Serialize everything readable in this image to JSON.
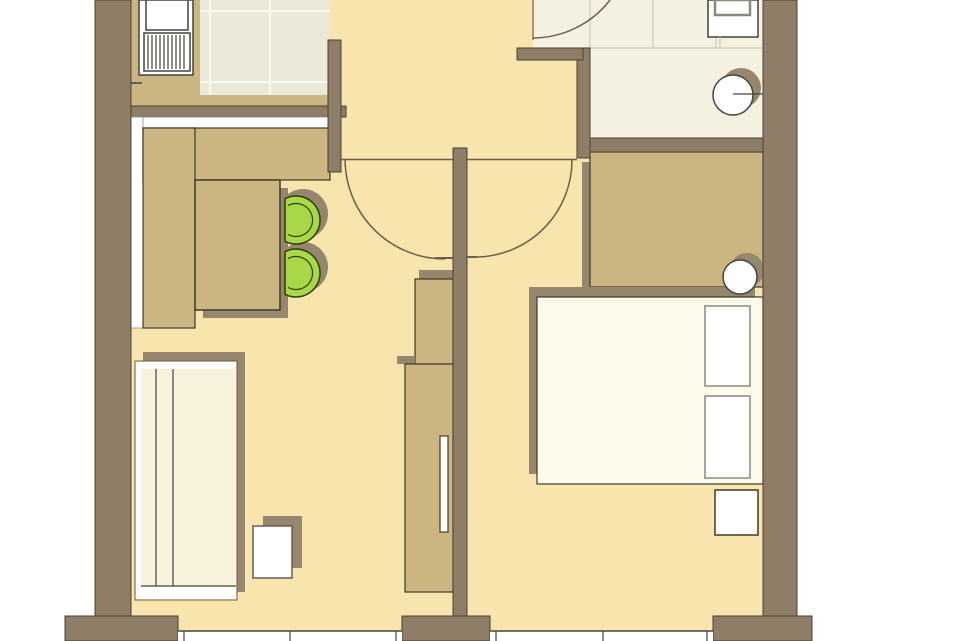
{
  "title": "apartment-floor-plan",
  "canvas": {
    "width": 960,
    "height": 641,
    "background": "#ffffff"
  },
  "palette": {
    "wall": "#8e7d67",
    "wallStroke": "#4c4134",
    "floor": "#f8e4ad",
    "bathFloor": "#f5f1e1",
    "tile": "#e9e8d9",
    "grout": "#fafaf0",
    "tan": "#cbb581",
    "furnStroke": "#3f3b2b",
    "cream": "#f8f2dc",
    "bedCream": "#fdfaeb",
    "white": "#ffffff",
    "shadow": "#95866d",
    "thinLine": "#6a5f4d",
    "dark": "#45433b",
    "grayBorder": "#8a887c",
    "tileLine": "#c6c2b0",
    "green": "#a8d847",
    "greenStroke": "#2e3c04"
  },
  "rooms": [
    "kitchen",
    "living-room",
    "hallway",
    "bathroom",
    "bedroom"
  ],
  "shapes": [
    {
      "name": "floor-hallway",
      "type": "rect",
      "rect": [
        330,
        0,
        247,
        160
      ],
      "fill": "floor",
      "interactable": false
    },
    {
      "name": "floor-living-room",
      "type": "rect",
      "rect": [
        131,
        106,
        322,
        525
      ],
      "fill": "floor",
      "interactable": false
    },
    {
      "name": "floor-bedroom",
      "type": "rect",
      "rect": [
        467,
        138,
        296,
        493
      ],
      "fill": "floor",
      "interactable": false
    },
    {
      "name": "floor-bathroom",
      "type": "rect",
      "rect": [
        590,
        0,
        173,
        140
      ],
      "fill": "bathFloor",
      "interactable": false
    },
    {
      "name": "floor-bathroom-entry",
      "type": "rect",
      "rect": [
        533,
        0,
        57,
        48
      ],
      "fill": "bathFloor",
      "interactable": false
    },
    {
      "name": "floor-kitchen-tiles",
      "type": "rect",
      "rect": [
        200,
        0,
        130,
        95
      ],
      "fill": "tile",
      "interactable": false
    },
    {
      "name": "kitchen-tile-grout-vertical",
      "type": "vlines",
      "xs": [
        210,
        270
      ],
      "y1": 0,
      "y2": 95,
      "stroke": "grout",
      "sw": 2,
      "interactable": false
    },
    {
      "name": "kitchen-tile-grout-horizontal",
      "type": "hlines",
      "ys": [
        11,
        82
      ],
      "x1": 200,
      "x2": 330,
      "stroke": "grout",
      "sw": 2,
      "interactable": false
    },
    {
      "name": "bathroom-tile-lines-vertical",
      "type": "vlines",
      "xs": [
        590,
        653,
        716
      ],
      "y1": 0,
      "y2": 48,
      "stroke": "tileLine",
      "sw": 1,
      "interactable": false
    },
    {
      "name": "bathroom-tile-line-horizontal",
      "type": "hlines",
      "ys": [
        48
      ],
      "x1": 590,
      "x2": 763,
      "stroke": "tileLine",
      "sw": 1,
      "interactable": false
    },
    {
      "name": "kitchen-counter-left",
      "type": "rect",
      "rect": [
        131,
        0,
        69,
        106
      ],
      "fill": "tan",
      "interactable": false
    },
    {
      "name": "kitchen-counter-bottom",
      "type": "rect",
      "rect": [
        200,
        95,
        130,
        11
      ],
      "fill": "tan",
      "interactable": false
    },
    {
      "name": "kitchen-sink-unit",
      "type": "rect",
      "rect": [
        139,
        0,
        54,
        75
      ],
      "fill": "white",
      "stroke": "dark",
      "sw": 1.5,
      "interactable": false
    },
    {
      "name": "kitchen-sink-bowl",
      "type": "rect",
      "rect": [
        146,
        0,
        42,
        30
      ],
      "fill": "white",
      "stroke": "dark",
      "sw": 1.5,
      "interactable": false
    },
    {
      "name": "kitchen-sink-drainer",
      "type": "rect",
      "rect": [
        144,
        33,
        46,
        38
      ],
      "fill": "white",
      "stroke": "dark",
      "sw": 1.5,
      "interactable": false
    },
    {
      "name": "kitchen-drainer-ribs",
      "type": "vlines",
      "xs": [
        148,
        152,
        156,
        160,
        164,
        168,
        172,
        176,
        180,
        184
      ],
      "y1": 35,
      "y2": 69,
      "stroke": "dark",
      "sw": 1.2,
      "interactable": false
    },
    {
      "name": "kitchen-counter-joint-mark",
      "type": "line",
      "p": [
        131,
        83,
        142,
        83
      ],
      "stroke": "dark",
      "sw": 1.5,
      "interactable": false
    },
    {
      "name": "wall-north-kitchen",
      "type": "rect",
      "rect": [
        131,
        106,
        215,
        11
      ],
      "fill": "wall",
      "stroke": "wallStroke",
      "sw": 1,
      "interactable": false
    },
    {
      "name": "sideboard-worktop-top",
      "type": "rect",
      "rect": [
        131,
        117,
        199,
        11
      ],
      "fill": "white",
      "stroke": "grayBorder",
      "sw": 0.75,
      "interactable": false
    },
    {
      "name": "sideboard-worktop-left",
      "type": "rect",
      "rect": [
        131,
        117,
        12,
        211
      ],
      "fill": "white",
      "stroke": "grayBorder",
      "sw": 0.75,
      "interactable": false
    },
    {
      "name": "sideboard-cabinet-top",
      "type": "rect",
      "rect": [
        143,
        128,
        187,
        52
      ],
      "fill": "tan",
      "stroke": "furnStroke",
      "sw": 1.2,
      "interactable": false
    },
    {
      "name": "sideboard-cabinet-left",
      "type": "rect",
      "rect": [
        143,
        128,
        52,
        200
      ],
      "fill": "tan",
      "stroke": "furnStroke",
      "sw": 1.2,
      "interactable": false
    },
    {
      "name": "dining-table-shadow",
      "type": "rect",
      "rect": [
        203,
        188,
        85,
        130
      ],
      "fill": "shadow",
      "interactable": false
    },
    {
      "name": "dining-table",
      "type": "rect",
      "rect": [
        195,
        180,
        85,
        130
      ],
      "fill": "tan",
      "stroke": "furnStroke",
      "sw": 1.5,
      "interactable": false
    },
    {
      "name": "chair-1-shadow",
      "type": "path",
      "d": "M 287 194.8 A 25 25 0 1 1 287 233.2 Z",
      "fill": "shadow",
      "interactable": false
    },
    {
      "name": "chair-2-shadow",
      "type": "path",
      "d": "M 287 247.8 A 25 25 0 1 1 287 286.2 Z",
      "fill": "shadow",
      "interactable": false
    },
    {
      "name": "chair-1",
      "type": "path",
      "d": "M 285 198.7 A 24 24 0 1 1 285 241.3 Z",
      "fill": "green",
      "stroke": "greenStroke",
      "sw": 1.5,
      "interactable": false
    },
    {
      "name": "chair-2",
      "type": "path",
      "d": "M 285 251.7 A 24 24 0 1 1 285 294.3 Z",
      "fill": "green",
      "stroke": "greenStroke",
      "sw": 1.5,
      "interactable": false
    },
    {
      "name": "chair-1-backrest-line",
      "type": "path",
      "d": "M 288 205.6 A 16.5 16.5 0 1 1 288 234.4",
      "fill": "none",
      "stroke": "greenStroke",
      "sw": 1.2,
      "interactable": false
    },
    {
      "name": "chair-2-backrest-line",
      "type": "path",
      "d": "M 288 258.6 A 16.5 16.5 0 1 1 288 287.4",
      "fill": "none",
      "stroke": "greenStroke",
      "sw": 1.2,
      "interactable": false
    },
    {
      "name": "sofa-shadow",
      "type": "rect",
      "rect": [
        143,
        352,
        102,
        240
      ],
      "fill": "shadow",
      "interactable": false
    },
    {
      "name": "sofa-body",
      "type": "rect",
      "rect": [
        135,
        361,
        102,
        239
      ],
      "fill": "cream",
      "stroke": "thinLine",
      "sw": 1,
      "interactable": false
    },
    {
      "name": "sofa-top-frame",
      "type": "rect",
      "rect": [
        136,
        362,
        100,
        7
      ],
      "fill": "white",
      "interactable": false
    },
    {
      "name": "sofa-left-frame",
      "type": "rect",
      "rect": [
        136,
        362,
        5,
        237
      ],
      "fill": "white",
      "interactable": false
    },
    {
      "name": "sofa-back-line-1",
      "type": "line",
      "p": [
        156,
        369,
        156,
        586
      ],
      "stroke": "dark",
      "sw": 1.2,
      "interactable": false
    },
    {
      "name": "sofa-back-line-2",
      "type": "line",
      "p": [
        173,
        369,
        173,
        586
      ],
      "stroke": "dark",
      "sw": 1.2,
      "interactable": false
    },
    {
      "name": "sofa-seat-front-line",
      "type": "line",
      "p": [
        141,
        586,
        236,
        586
      ],
      "stroke": "dark",
      "sw": 1.2,
      "interactable": false
    },
    {
      "name": "sofa-bottom-frame",
      "type": "rect",
      "rect": [
        141,
        587,
        95,
        12
      ],
      "fill": "white",
      "interactable": false
    },
    {
      "name": "side-table-shadow",
      "type": "rect",
      "rect": [
        263,
        516,
        39,
        52
      ],
      "fill": "shadow",
      "interactable": false
    },
    {
      "name": "side-table",
      "type": "rect",
      "rect": [
        253,
        526,
        39,
        52
      ],
      "fill": "white",
      "stroke": "thinLine",
      "sw": 1.5,
      "interactable": false
    },
    {
      "name": "tv-cabinet-upper-shadow",
      "type": "rect",
      "rect": [
        419,
        270,
        47,
        9
      ],
      "fill": "shadow",
      "interactable": false
    },
    {
      "name": "tv-cabinet-upper",
      "type": "rect",
      "rect": [
        415,
        279,
        38,
        85
      ],
      "fill": "tan",
      "stroke": "furnStroke",
      "sw": 1.2,
      "interactable": false
    },
    {
      "name": "tv-cabinet-lower-shadow",
      "type": "rect",
      "rect": [
        397,
        356,
        18,
        8
      ],
      "fill": "shadow",
      "interactable": false
    },
    {
      "name": "tv-cabinet-lower",
      "type": "rect",
      "rect": [
        405,
        364,
        48,
        228
      ],
      "fill": "tan",
      "stroke": "furnStroke",
      "sw": 1.2,
      "interactable": false
    },
    {
      "name": "tv-screen",
      "type": "rect",
      "rect": [
        440,
        436,
        8,
        96
      ],
      "fill": "white",
      "stroke": "furnStroke",
      "sw": 1.2,
      "interactable": false
    },
    {
      "name": "wardrobe-shadow",
      "type": "rect",
      "rect": [
        582,
        162,
        173,
        135
      ],
      "fill": "shadow",
      "interactable": false
    },
    {
      "name": "wardrobe",
      "type": "rect",
      "rect": [
        590,
        152,
        173,
        135
      ],
      "fill": "tan",
      "stroke": "furnStroke",
      "sw": 1.2,
      "interactable": false
    },
    {
      "name": "bed-shadow",
      "type": "rect",
      "rect": [
        529,
        287,
        226,
        187
      ],
      "fill": "shadow",
      "interactable": false
    },
    {
      "name": "bed",
      "type": "rect",
      "rect": [
        537,
        297,
        226,
        187
      ],
      "fill": "bedCream",
      "stroke": "furnStroke",
      "sw": 1.2,
      "interactable": false
    },
    {
      "name": "bed-pillow-1",
      "type": "rect",
      "rect": [
        705,
        306,
        45,
        80
      ],
      "fill": "white",
      "stroke": "grayBorder",
      "sw": 1.5,
      "interactable": false
    },
    {
      "name": "bed-pillow-2",
      "type": "rect",
      "rect": [
        705,
        396,
        45,
        82
      ],
      "fill": "white",
      "stroke": "grayBorder",
      "sw": 1.5,
      "interactable": false
    },
    {
      "name": "bedside-stool-shadow",
      "type": "circle",
      "c": [
        747,
        270
      ],
      "r": 17,
      "fill": "shadow",
      "interactable": false
    },
    {
      "name": "bedside-stool",
      "type": "circle",
      "c": [
        740,
        277
      ],
      "r": 17,
      "fill": "white",
      "stroke": "dark",
      "sw": 1.5,
      "interactable": false
    },
    {
      "name": "nightstand",
      "type": "rect",
      "rect": [
        715,
        490,
        43,
        45
      ],
      "fill": "white",
      "stroke": "furnStroke",
      "sw": 1.5,
      "interactable": false
    },
    {
      "name": "toilet",
      "type": "rect",
      "rect": [
        708,
        0,
        50,
        37
      ],
      "fill": "white",
      "stroke": "dark",
      "sw": 1.5,
      "interactable": false
    },
    {
      "name": "toilet-tank",
      "type": "rect",
      "rect": [
        715,
        0,
        35,
        15
      ],
      "fill": "white",
      "stroke": "grayBorder",
      "sw": 2.5,
      "interactable": false
    },
    {
      "name": "toilet-connector-line",
      "type": "line",
      "p": [
        720,
        37,
        720,
        48
      ],
      "stroke": "tileLine",
      "sw": 1.2,
      "interactable": false
    },
    {
      "name": "washbasin-shadow",
      "type": "circle",
      "c": [
        741,
        88
      ],
      "r": 20,
      "fill": "shadow",
      "interactable": false
    },
    {
      "name": "washbasin",
      "type": "circle",
      "c": [
        733,
        95
      ],
      "r": 20,
      "fill": "white",
      "stroke": "dark",
      "sw": 1.5,
      "interactable": false
    },
    {
      "name": "washbasin-wall-line",
      "type": "line",
      "p": [
        733,
        94,
        763,
        94
      ],
      "stroke": "dark",
      "sw": 1.2,
      "interactable": false
    },
    {
      "name": "wall-left",
      "type": "rect",
      "rect": [
        95,
        0,
        36,
        617
      ],
      "fill": "wall",
      "stroke": "wallStroke",
      "sw": 1,
      "interactable": false
    },
    {
      "name": "wall-kitchen-stub",
      "type": "rect",
      "rect": [
        328,
        40,
        13,
        132
      ],
      "fill": "wall",
      "stroke": "wallStroke",
      "sw": 1,
      "interactable": false
    },
    {
      "name": "wall-partition",
      "type": "rect",
      "rect": [
        453,
        148,
        14,
        468
      ],
      "fill": "wall",
      "stroke": "wallStroke",
      "sw": 1,
      "interactable": false
    },
    {
      "name": "wall-bathroom-west",
      "type": "rect",
      "rect": [
        577,
        48,
        13,
        110
      ],
      "fill": "wall",
      "stroke": "wallStroke",
      "sw": 1,
      "interactable": false
    },
    {
      "name": "wall-bathroom-stub",
      "type": "rect",
      "rect": [
        517,
        48,
        66,
        12
      ],
      "fill": "wall",
      "stroke": "wallStroke",
      "sw": 1,
      "interactable": false
    },
    {
      "name": "wall-bedroom-north",
      "type": "rect",
      "rect": [
        590,
        138,
        173,
        14
      ],
      "fill": "wall",
      "stroke": "wallStroke",
      "sw": 1,
      "interactable": false
    },
    {
      "name": "wall-right",
      "type": "rect",
      "rect": [
        763,
        0,
        34,
        616
      ],
      "fill": "wall",
      "stroke": "wallStroke",
      "sw": 1,
      "interactable": false
    },
    {
      "name": "wall-pier-left",
      "type": "rect",
      "rect": [
        65,
        616,
        113,
        25
      ],
      "fill": "wall",
      "stroke": "wallStroke",
      "sw": 1,
      "interactable": false
    },
    {
      "name": "wall-pier-center",
      "type": "rect",
      "rect": [
        402,
        616,
        88,
        25
      ],
      "fill": "wall",
      "stroke": "wallStroke",
      "sw": 1,
      "interactable": false
    },
    {
      "name": "wall-pier-right",
      "type": "rect",
      "rect": [
        713,
        616,
        99,
        25
      ],
      "fill": "wall",
      "stroke": "wallStroke",
      "sw": 1,
      "interactable": false
    },
    {
      "name": "window-south-left",
      "type": "rect",
      "rect": [
        178,
        631,
        224,
        10
      ],
      "fill": "white",
      "interactable": false
    },
    {
      "name": "window-south-left-top-line",
      "type": "hlines",
      "ys": [
        631
      ],
      "x1": 178,
      "x2": 402,
      "stroke": "dark",
      "sw": 1.5,
      "interactable": false
    },
    {
      "name": "window-south-left-mullions",
      "type": "vlines",
      "xs": [
        184,
        290,
        396
      ],
      "y1": 631,
      "y2": 641,
      "stroke": "dark",
      "sw": 1.2,
      "interactable": false
    },
    {
      "name": "window-south-right",
      "type": "rect",
      "rect": [
        490,
        631,
        223,
        10
      ],
      "fill": "white",
      "interactable": false
    },
    {
      "name": "window-south-right-top-line",
      "type": "hlines",
      "ys": [
        631
      ],
      "x1": 490,
      "x2": 713,
      "stroke": "dark",
      "sw": 1.5,
      "interactable": false
    },
    {
      "name": "window-south-right-mullions",
      "type": "vlines",
      "xs": [
        496,
        603,
        707
      ],
      "y1": 631,
      "y2": 641,
      "stroke": "dark",
      "sw": 1.2,
      "interactable": false
    },
    {
      "name": "threshold-living-door",
      "type": "line",
      "p": [
        340,
        159.5,
        453,
        159.5
      ],
      "stroke": "thinLine",
      "sw": 1.5,
      "interactable": false
    },
    {
      "name": "threshold-bedroom-door",
      "type": "line",
      "p": [
        467,
        159.5,
        577,
        159.5
      ],
      "stroke": "thinLine",
      "sw": 1.5,
      "interactable": false
    },
    {
      "name": "door-living-swing-arc",
      "type": "path",
      "d": "M 345 159 A 100 100 0 0 0 445 259",
      "fill": "none",
      "stroke": "thinLine",
      "sw": 1.5,
      "interactable": false
    },
    {
      "name": "door-living-leaf",
      "type": "line",
      "p": [
        435,
        258,
        453,
        258
      ],
      "stroke": "thinLine",
      "sw": 2,
      "interactable": false
    },
    {
      "name": "door-bedroom-swing-arc",
      "type": "path",
      "d": "M 475 257 A 97 97 0 0 0 572 160",
      "fill": "none",
      "stroke": "thinLine",
      "sw": 1.5,
      "interactable": false
    },
    {
      "name": "door-bedroom-leaf",
      "type": "line",
      "p": [
        466,
        257,
        477,
        257
      ],
      "stroke": "thinLine",
      "sw": 2,
      "interactable": false
    },
    {
      "name": "door-bathroom-swing-arc",
      "type": "path",
      "d": "M 533 38 A 98 98 0 0 0 610 0",
      "fill": "none",
      "stroke": "thinLine",
      "sw": 1.5,
      "interactable": false
    },
    {
      "name": "door-bathroom-threshold-line",
      "type": "line",
      "p": [
        533,
        0,
        533,
        40
      ],
      "stroke": "thinLine",
      "sw": 1.2,
      "interactable": false
    }
  ]
}
